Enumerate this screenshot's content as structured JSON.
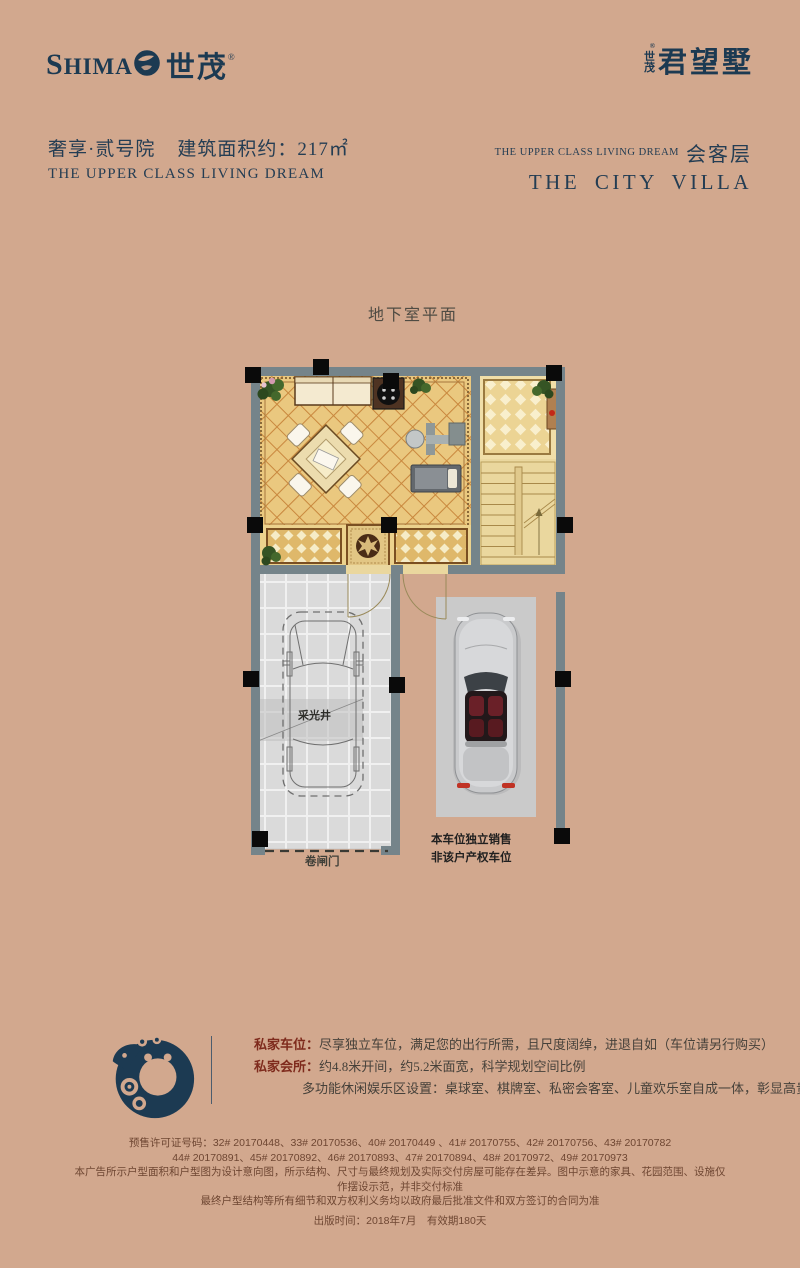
{
  "header": {
    "logo_left": {
      "en_first": "S",
      "en_rest": "HIMA",
      "cn": "世茂",
      "reg": "®"
    },
    "logo_right": {
      "prefix_top": "世",
      "prefix_bottom": "茂",
      "reg": "®",
      "name": "君望墅"
    },
    "left": {
      "title_cn": "奢享·贰号院",
      "area_label": "建筑面积约：217㎡",
      "subtitle_en": "THE UPPER CLASS LIVING DREAM"
    },
    "right": {
      "tagline_en": "THE UPPER CLASS LIVING DREAM",
      "floor_cn": "会客层",
      "title_en": "THE CITY VILLA"
    }
  },
  "floorplan": {
    "title": "地下室平面",
    "labels": {
      "light_well": "采光井",
      "roller_door": "卷闸门",
      "parking_line1": "本车位独立销售",
      "parking_line2": "非该户产权车位"
    }
  },
  "features": {
    "items": [
      {
        "lead": "私家车位：",
        "text": "尽享独立车位，满足您的出行所需，且尺度阔绰，进退自如（车位请另行购买）"
      },
      {
        "lead": "私家会所：",
        "text": "约4.8米开间，约5.2米面宽，科学规划空间比例"
      },
      {
        "lead": "",
        "text": "多功能休闲娱乐区设置：桌球室、棋牌室、私密会客室、儿童欢乐室自成一体，彰显高贵生活品质"
      }
    ]
  },
  "legal": {
    "lines": [
      "预售许可证号码：32# 20170448、33# 20170536、40# 20170449 、41# 20170755、42# 20170756、43# 20170782",
      "44# 20170891、45# 20170892、46# 20170893、47# 20170894、48# 20170972、49# 20170973",
      "本广告所示户型面积和户型图为设计意向图，所示结构、尺寸与最终规划及实际交付房屋可能存在差异。图中示意的家具、花园范围、设施仅作摆设示范，并非交付标准",
      "最终户型结构等所有细节和双方权利义务均以政府最后批准文件和双方签订的合同为准",
      "出版时间：2018年7月　有效期180天"
    ]
  }
}
